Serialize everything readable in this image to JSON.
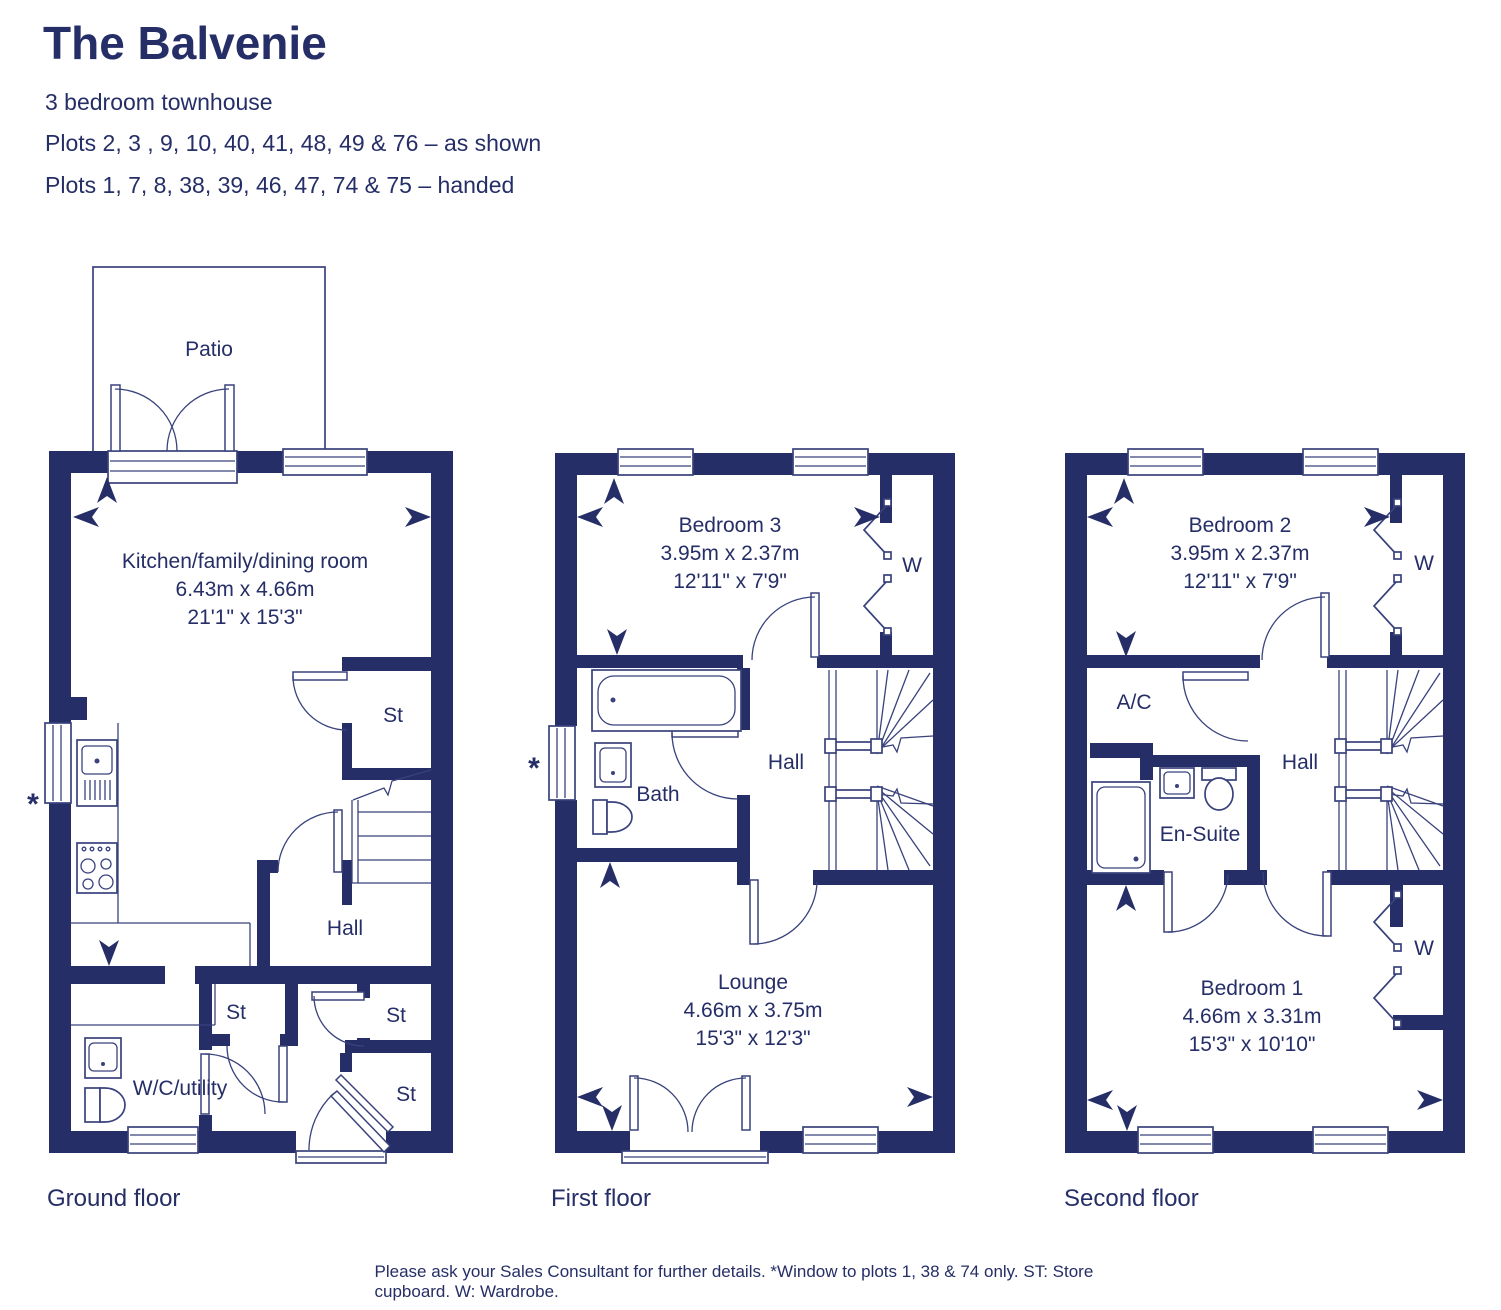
{
  "colors": {
    "navy": "#252e66",
    "line": "#39427c",
    "background": "#ffffff"
  },
  "header": {
    "title": "The Balvenie",
    "subtitle": "3 bedroom townhouse",
    "plots_as_shown": "Plots 2, 3 , 9, 10, 40, 41, 48, 49 & 76 – as shown",
    "plots_handed": "Plots 1, 7, 8, 38, 39, 46, 47, 74 & 75 – handed"
  },
  "floors": {
    "ground": {
      "label": "Ground floor",
      "patio": "Patio",
      "kitchen": {
        "name": "Kitchen/family/dining room",
        "metric": "6.43m x 4.66m",
        "imperial": "21'1\" x 15'3\""
      },
      "hall": "Hall",
      "wc": "W/C/utility",
      "store": "St",
      "window_note_symbol": "*"
    },
    "first": {
      "label": "First floor",
      "bedroom3": {
        "name": "Bedroom 3",
        "metric": "3.95m x 2.37m",
        "imperial": "12'11\" x 7'9\""
      },
      "lounge": {
        "name": "Lounge",
        "metric": "4.66m x 3.75m",
        "imperial": "15'3\" x 12'3\""
      },
      "bath": "Bath",
      "hall": "Hall",
      "wardrobe": "W",
      "window_note_symbol": "*"
    },
    "second": {
      "label": "Second floor",
      "bedroom2": {
        "name": "Bedroom 2",
        "metric": "3.95m x 2.37m",
        "imperial": "12'11\" x 7'9\""
      },
      "bedroom1": {
        "name": "Bedroom 1",
        "metric": "4.66m x 3.31m",
        "imperial": "15'3\" x 10'10\""
      },
      "ensuite": "En-Suite",
      "airing_cupboard": "A/C",
      "hall": "Hall",
      "wardrobe": "W"
    }
  },
  "footer": "Please ask your Sales Consultant for further details. *Window to plots 1, 38 & 74 only. ST: Store cupboard. W: Wardrobe."
}
